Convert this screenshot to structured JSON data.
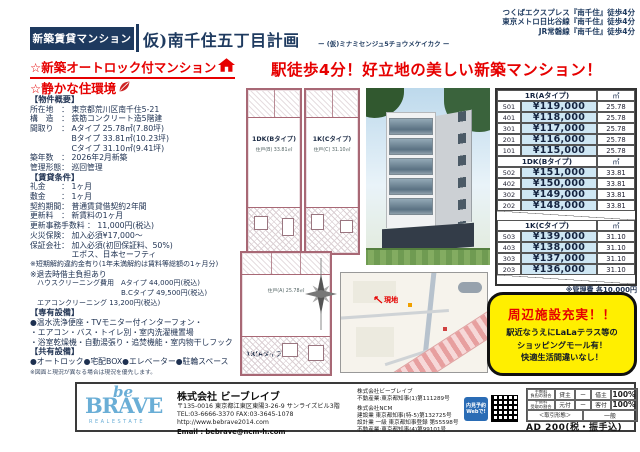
{
  "header": {
    "badge": "新築賃貸マンション",
    "title": "仮)南千住五丁目計画",
    "subtitle": "ー (仮)ミナミセンジュ5チョウメケイカク ー",
    "stations": [
      "つくばエクスプレス『南千住』徒歩4分",
      "東京メトロ日比谷線『南千住』徒歩4分",
      "JR常磐線『南千住』徒歩4分"
    ]
  },
  "features": [
    "☆新築オートロック付マンション",
    "☆静かな住環境"
  ],
  "headline": "駅徒歩4分！好立地の美しい新築マンション！",
  "left": {
    "lines": [
      "【物件概要】",
      "所在地　： 東京都荒川区南千住5-21",
      "構　造　： 鉄筋コンクリート造5階建",
      "間取り　： Aタイプ 25.78㎡(7.80坪)",
      "　　　　　 Bタイプ 33.81㎡(10.23坪)",
      "　　　　　 Cタイプ 31.10㎡(9.41坪)",
      "築年数　： 2026年2月新築",
      "管理形態： 巡回管理",
      "【賃貸条件】",
      "礼金　　： 1ヶ月",
      "敷金　　： 1ヶ月",
      "契約期間： 普通賃貸借契約2年間",
      "更新料　： 新賃料の1ヶ月",
      "更新事務手数料 ： 11,000円(税込)",
      "火災保険： 加入必須¥17,000～",
      "保証会社： 加入必須(初回保証料、50%)",
      "　　　　　 エポス、日本セーフティ",
      "※短期解約違約金有り(1年未満解約は賃料等総額の1ヶ月分)",
      "※退去時借主負担あり",
      "　ハウスクリーニング費用　Aタイプ 44,000円(税込)",
      "　　　　　　　　　　　　　B.Cタイプ 49,500円(税込)",
      "　エアコンクリーニング 13,200円(税込)",
      "【専有設備】",
      "●温水洗浄便座・TVモニター付インターフォン・",
      "・エアコン・バス・トイレ別・室内洗濯機置場",
      "・浴室乾燥機・自動湯張り・追焚機能・室内物干しフック",
      "【共有設備】",
      "●オートロック●宅配BOX●エレベーター●駐輪スペース",
      "※図面と現況が異なる場合は現況を優先します。"
    ]
  },
  "plans": {
    "b": {
      "label": "1DK(Bタイプ)",
      "info": "住戸(B) 33.81㎡"
    },
    "c": {
      "label": "1K(Cタイプ)",
      "info": "住戸(C) 31.10㎡"
    },
    "a": {
      "label": "1R(Aタイプ)",
      "info": "住戸(A) 25.78㎡"
    }
  },
  "map": {
    "marker": "現地"
  },
  "price_table": {
    "unit": "㎡",
    "sections": [
      {
        "type": "1R(Aタイプ)",
        "rows": [
          {
            "room": "501",
            "price": "¥119,000",
            "area": "25.78"
          },
          {
            "room": "401",
            "price": "¥118,000",
            "area": "25.78"
          },
          {
            "room": "301",
            "price": "¥117,000",
            "area": "25.78"
          },
          {
            "room": "201",
            "price": "¥116,000",
            "area": "25.78"
          },
          {
            "room": "101",
            "price": "¥115,000",
            "area": "25.78"
          }
        ]
      },
      {
        "type": "1DK(Bタイプ)",
        "rows": [
          {
            "room": "502",
            "price": "¥151,000",
            "area": "33.81"
          },
          {
            "room": "402",
            "price": "¥150,000",
            "area": "33.81"
          },
          {
            "room": "302",
            "price": "¥149,000",
            "area": "33.81"
          },
          {
            "room": "202",
            "price": "¥148,000",
            "area": "33.81"
          }
        ]
      },
      {
        "type": "1K(Cタイプ)",
        "rows": [
          {
            "room": "503",
            "price": "¥139,000",
            "area": "31.10"
          },
          {
            "room": "403",
            "price": "¥138,000",
            "area": "31.10"
          },
          {
            "room": "303",
            "price": "¥137,000",
            "area": "31.10"
          },
          {
            "room": "203",
            "price": "¥136,000",
            "area": "31.10"
          }
        ]
      }
    ],
    "note": "※管理費 各10,000円"
  },
  "highlight": {
    "l1": "周辺施設充実！！",
    "l2": "駅近なうえにLaLaテラス等の",
    "l3": "ショッピングモール有！",
    "l4": "快適生活間違いなし！"
  },
  "footer": {
    "logo": {
      "script": "be",
      "name": "BRAVE",
      "tag": "REALESTATE"
    },
    "company": "株式会社 ビーブレイブ",
    "address": "〒135-0016 東京都江東区東陽3-26-9 サンライズビル3階",
    "telfax": "TEL:03-6666-3370 FAX:03-3645-1078",
    "url": "http://www.bebrave2014.com",
    "email": "Email : bebrave@ncm-h.com",
    "licenses": [
      "株式会社ビーブレイブ",
      "不動産業:東京都知事(1)第111289号",
      "株式会社NCM",
      "建設業 東京都知事(特-5)第132725号",
      "設計業 一級 東京都知事登録 第55598号",
      "不動産業:東京都知事(4)第99101号"
    ],
    "qr": {
      "l1": "内見予約",
      "l2": "Webで!"
    },
    "fee": {
      "r1": {
        "l1": "手数料",
        "l2": "負担の割合",
        "a": "貸主",
        "b": "ー",
        "c": "借主",
        "d": "100%"
      },
      "r2": {
        "l1": "手数料",
        "l2": "受取の割合",
        "a": "元付",
        "b": "ー",
        "c": "客付",
        "d": "100%"
      },
      "r3": {
        "label": "＜取引形態＞",
        "value": "一般"
      }
    },
    "ad": "AD 200(税・振手込)"
  },
  "colors": {
    "navy": "#1e3a5f",
    "red": "#e60000",
    "yellow": "#ffef00",
    "price_cell_blue": "#cfe7f4",
    "logo_blue": "#6aaed6"
  }
}
